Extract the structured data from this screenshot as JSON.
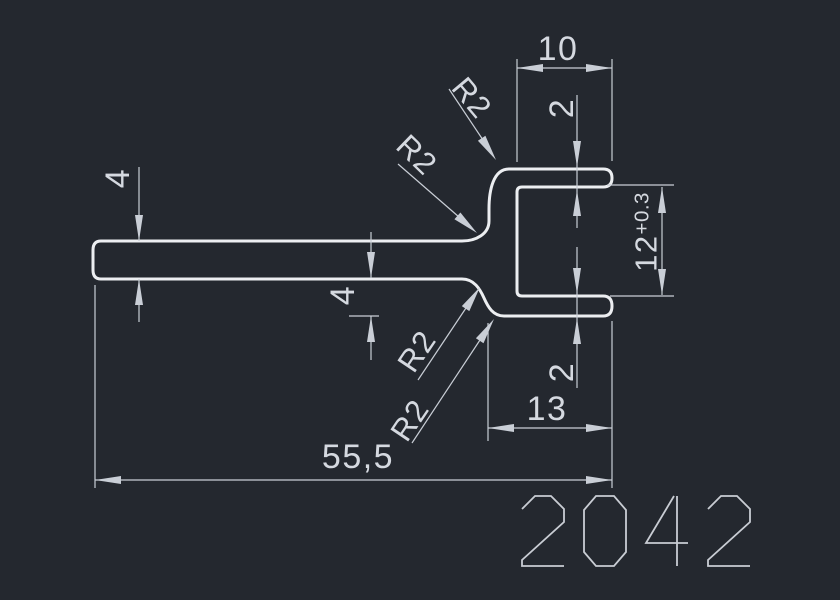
{
  "drawing": {
    "type": "profile-cross-section",
    "background_color": "#24282f",
    "profile_line_color": "#eceef1",
    "dimension_color": "#c9ced6",
    "text_color": "#d5d9e0"
  },
  "dimensions": {
    "bar_thickness": "4",
    "arm_drop": "4",
    "top_flange_length": "10",
    "top_flange_thickness": "2",
    "opening_height": "12",
    "opening_tolerance": "+0.3",
    "bottom_flange_thickness": "2",
    "bottom_flange_length": "13",
    "overall_length": "55,5",
    "fillet_radius_labels": [
      "R2",
      "R2",
      "R2",
      "R2"
    ]
  },
  "part_number": "2042"
}
